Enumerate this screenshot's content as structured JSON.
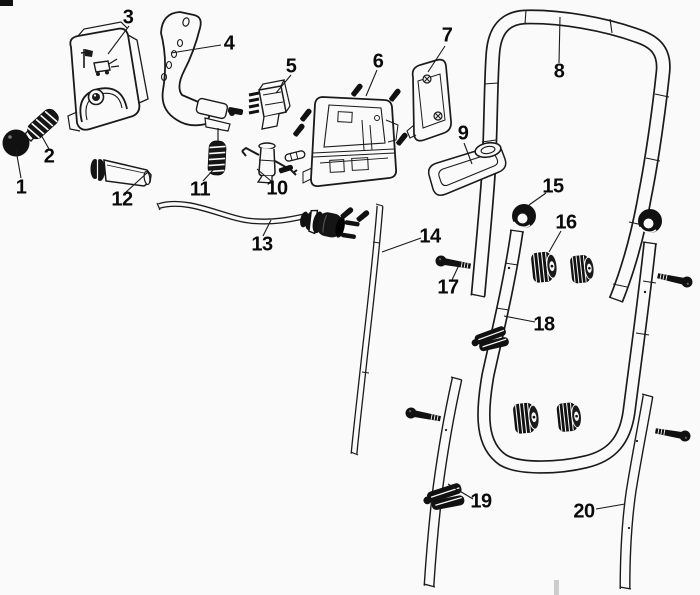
{
  "diagram": {
    "type": "exploded-parts-diagram",
    "colors": {
      "background": "#fbfafa",
      "ink": "#1a1a1a",
      "label": "#0a0a0a",
      "artifact_gray": "#cdcdcd"
    },
    "labels": [
      {
        "id": "1",
        "part": "push-button"
      },
      {
        "id": "2",
        "part": "button-spring"
      },
      {
        "id": "3",
        "part": "switchbox-cover"
      },
      {
        "id": "4",
        "part": "switch-lever"
      },
      {
        "id": "5",
        "part": "micro-switch"
      },
      {
        "id": "6",
        "part": "switchbox-base"
      },
      {
        "id": "7",
        "part": "switchbox-side-cover"
      },
      {
        "id": "8",
        "part": "upper-handle-bar"
      },
      {
        "id": "9",
        "part": "cable-guide-bracket"
      },
      {
        "id": "10",
        "part": "cable-hook"
      },
      {
        "id": "11",
        "part": "lever-spring"
      },
      {
        "id": "12",
        "part": "bushing-sleeve"
      },
      {
        "id": "13",
        "part": "power-cord-with-plug"
      },
      {
        "id": "14",
        "part": "control-rod"
      },
      {
        "id": "15",
        "part": "lock-ring"
      },
      {
        "id": "16",
        "part": "wing-knob"
      },
      {
        "id": "17",
        "part": "carriage-bolt"
      },
      {
        "id": "18",
        "part": "middle-handle-tube"
      },
      {
        "id": "19",
        "part": "cable-clamp"
      },
      {
        "id": "20",
        "part": "lower-handle-tube"
      }
    ]
  }
}
